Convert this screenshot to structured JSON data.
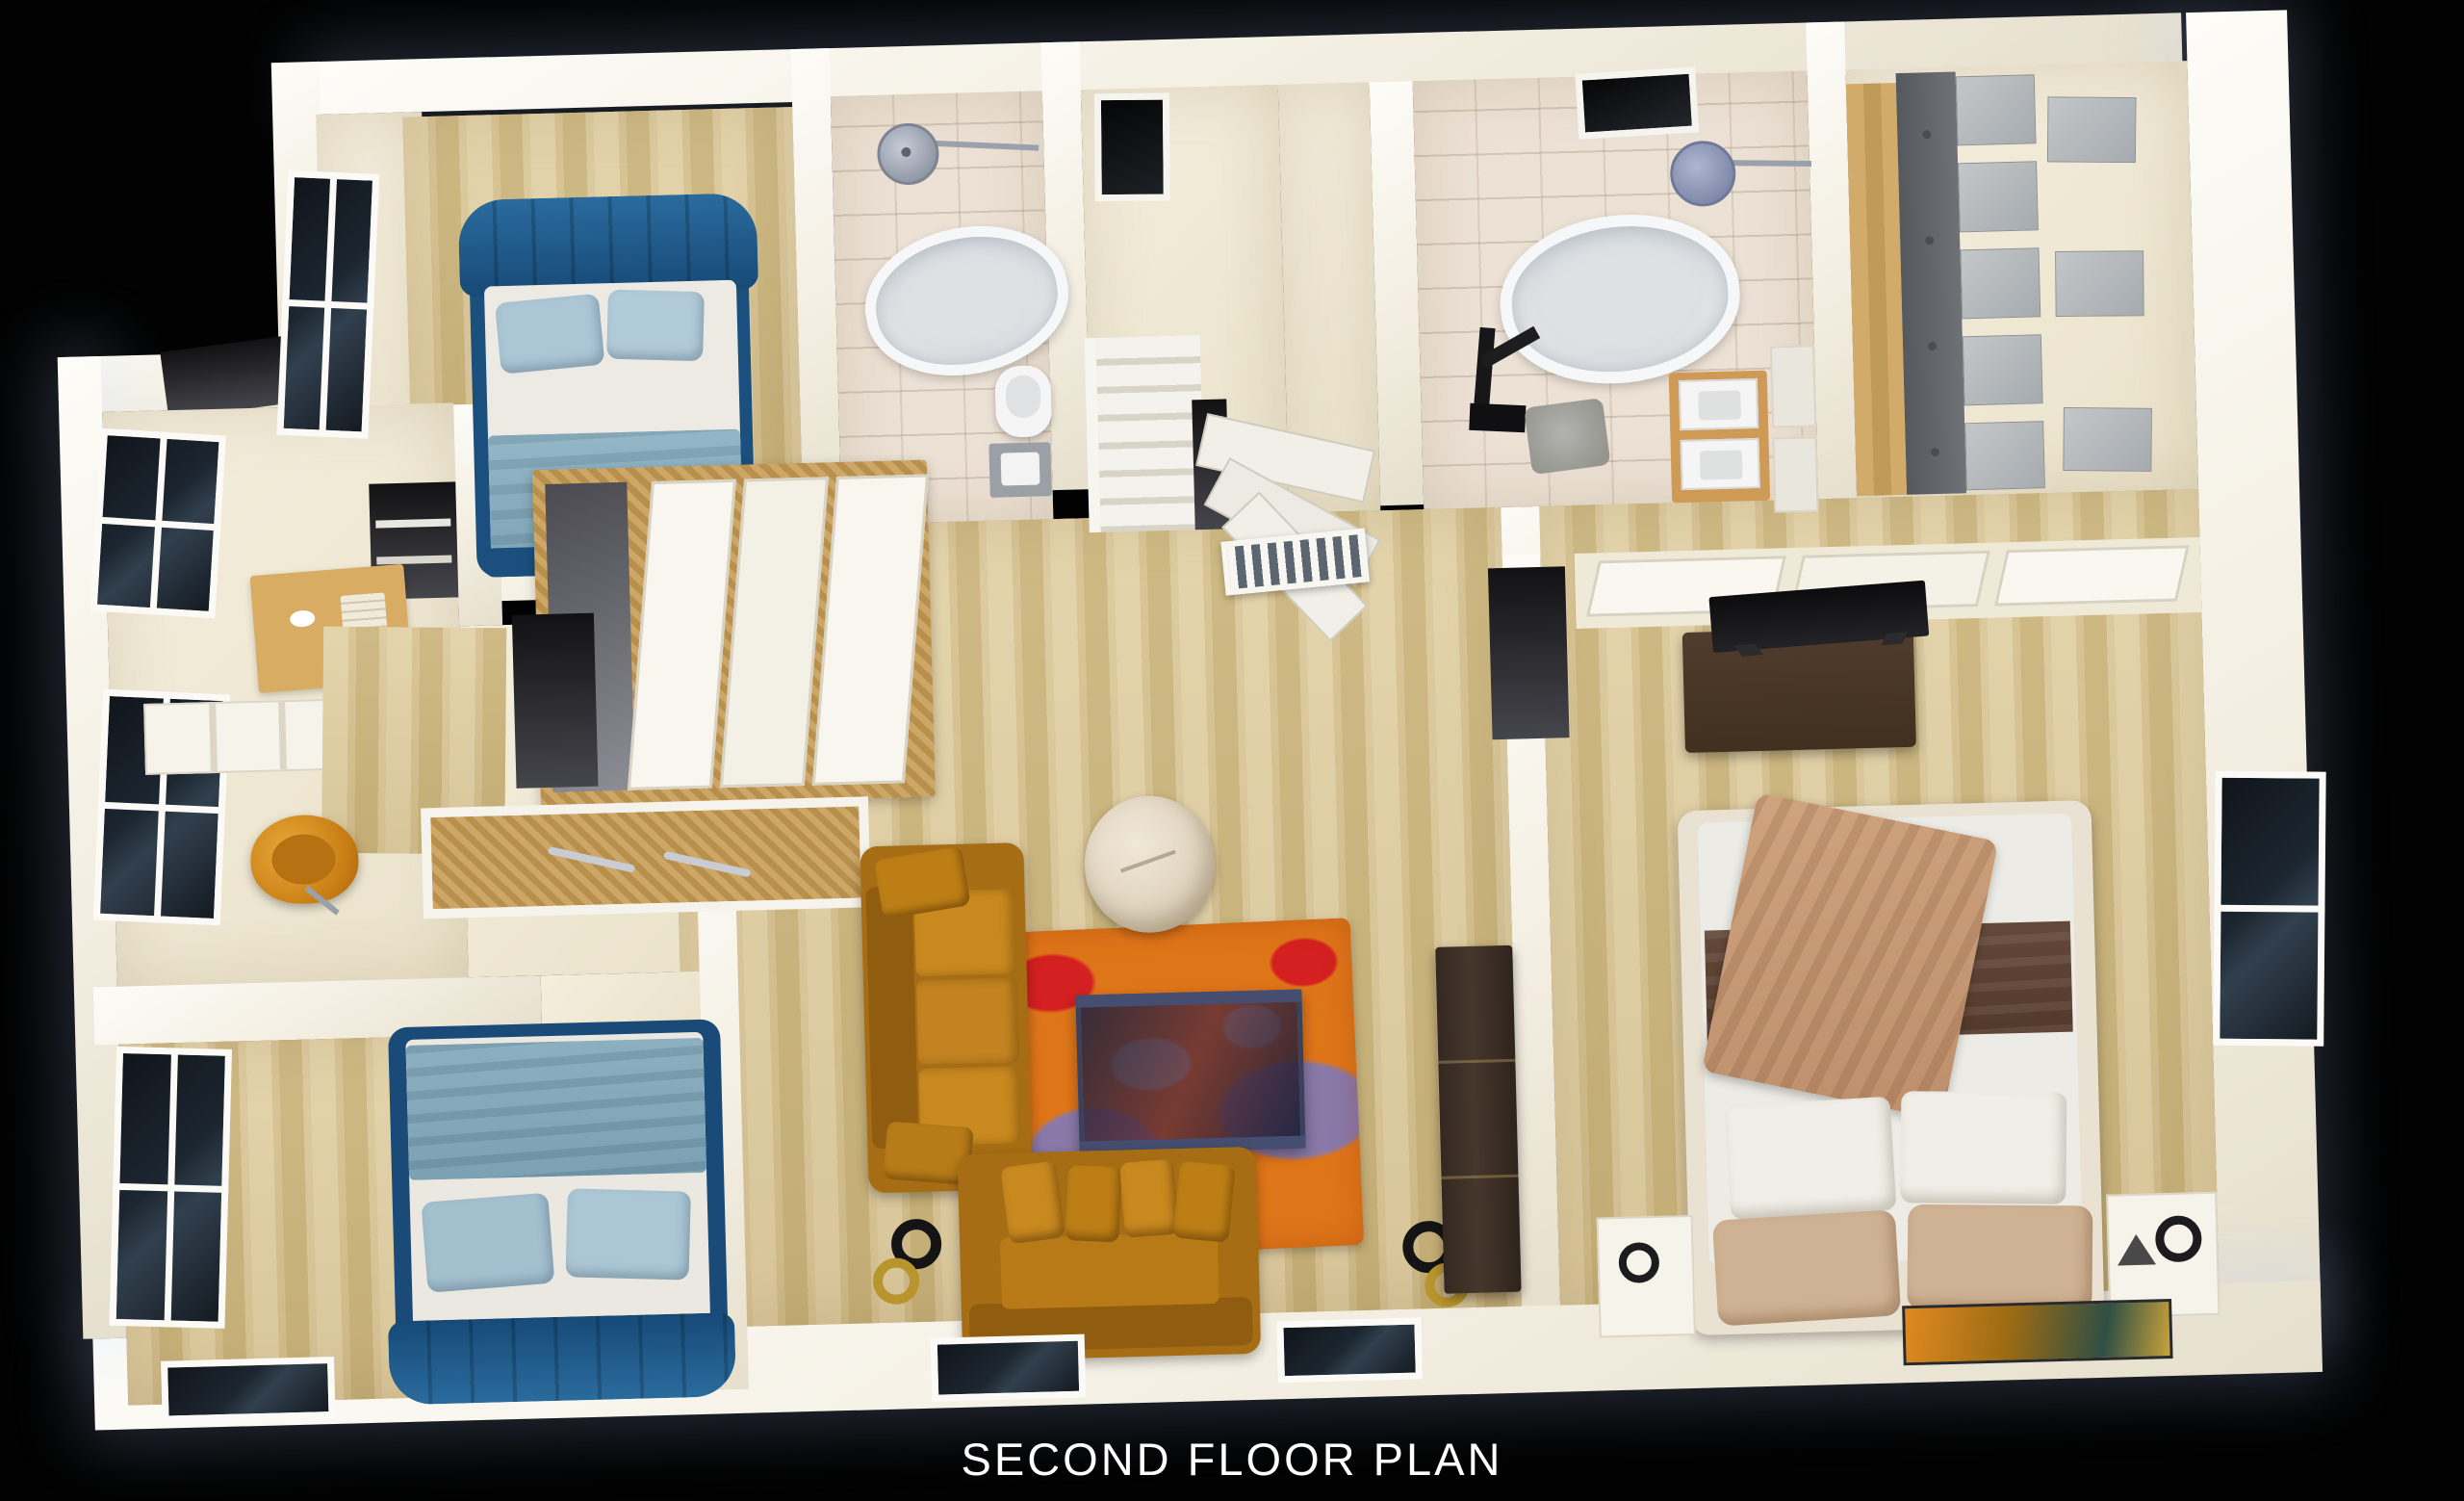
{
  "title": {
    "text": "SECOND FLOOR PLAN"
  },
  "palette": {
    "background": "#020202",
    "walls": "#f7f4ec",
    "floor_cream": "#f0e9d7",
    "floor_wood": "#d9c597",
    "bathroom_tile": "#ece1d5",
    "bed_blue_headboard": "#1d5a8a",
    "bed_blue_frame": "#1b4f7e",
    "bedding_light_blue": "#a9c5d3",
    "blanket_blue_gray": "#84a9ba",
    "sofa_mustard": "#b4771a",
    "rug_orange": "#df7519",
    "rug_red": "#cd1f1f",
    "rug_purple": "#8a79a8",
    "rug_gray": "#b9c4c2",
    "master_blanket_tan": "#c79a76",
    "master_band_brown": "#5d4434",
    "chair_orange": "#d98b1f",
    "closet_cabinet_gray": "#b3b8bc",
    "tv_console_brown": "#3c2f24",
    "lamp_gold": "#b9952e",
    "window_pane": "#141a21"
  }
}
